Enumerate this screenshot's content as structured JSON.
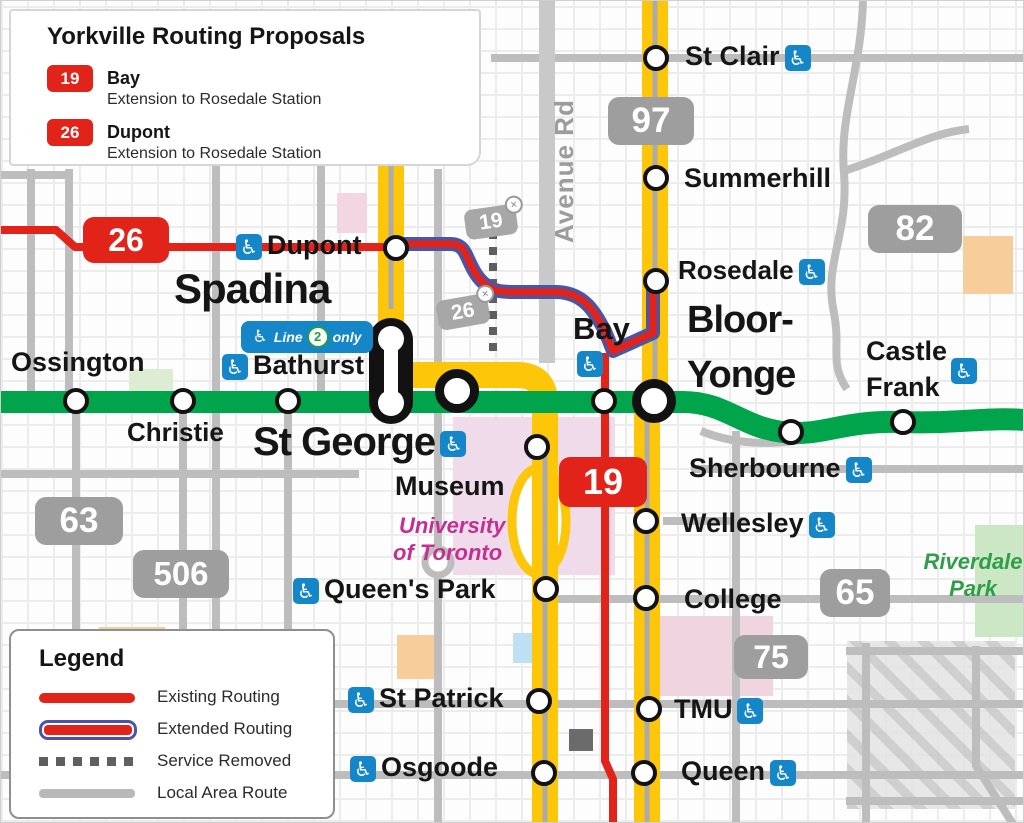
{
  "title_box": {
    "title": "Yorkville Routing Proposals",
    "routes": [
      {
        "number": "19",
        "name": "Bay",
        "description": "Extension to Rosedale Station"
      },
      {
        "number": "26",
        "name": "Dupont",
        "description": "Extension to Rosedale Station"
      }
    ]
  },
  "legend": {
    "title": "Legend",
    "items": [
      {
        "label": "Existing Routing",
        "swatch": "existing"
      },
      {
        "label": "Extended Routing",
        "swatch": "extended"
      },
      {
        "label": "Service Removed",
        "swatch": "removed"
      },
      {
        "label": "Local Area Route",
        "swatch": "local"
      }
    ]
  },
  "stations": {
    "st_clair": {
      "name": "St Clair"
    },
    "summerhill": {
      "name": "Summerhill"
    },
    "rosedale": {
      "name": "Rosedale"
    },
    "bloor_yonge": {
      "line1": "Bloor-",
      "line2": "Yonge"
    },
    "bay": {
      "name": "Bay"
    },
    "castle_frank": {
      "line1": "Castle",
      "line2": "Frank"
    },
    "sherbourne": {
      "name": "Sherbourne"
    },
    "wellesley": {
      "name": "Wellesley"
    },
    "college": {
      "name": "College"
    },
    "tmu": {
      "name": "TMU"
    },
    "queen": {
      "name": "Queen"
    },
    "osgoode": {
      "name": "Osgoode"
    },
    "st_patrick": {
      "name": "St Patrick"
    },
    "queens_park": {
      "name": "Queen's Park"
    },
    "museum": {
      "name": "Museum"
    },
    "st_george": {
      "name": "St George"
    },
    "spadina": {
      "name": "Spadina"
    },
    "bathurst": {
      "name": "Bathurst"
    },
    "ossington": {
      "name": "Ossington"
    },
    "christie": {
      "name": "Christie"
    },
    "dupont": {
      "name": "Dupont"
    }
  },
  "badges": {
    "b26_red": "26",
    "b19_red": "19",
    "b97": "97",
    "b82": "82",
    "b63": "63",
    "b506": "506",
    "b65": "65",
    "b75": "75",
    "b19_removed": "19",
    "b26_removed": "26"
  },
  "labels": {
    "avenue_rd": "Avenue Rd",
    "university_line1": "University",
    "university_line2": "of Toronto",
    "riverdale_line1": "Riverdale",
    "riverdale_line2": "Park"
  },
  "line2_badge": {
    "line_word": "Line",
    "number": "2",
    "only_word": "only"
  },
  "icons": {
    "accessibility": "♿",
    "removed_x": "✕"
  },
  "colors": {
    "line1_yellow": "#FDC609",
    "line2_green": "#00A44A",
    "route_red": "#E2231A",
    "extended_blue": "#4C55A4",
    "local_gray": "#BDBDBD",
    "accessibility_blue": "#1586C8",
    "badge_gray": "#9E9E9E"
  }
}
